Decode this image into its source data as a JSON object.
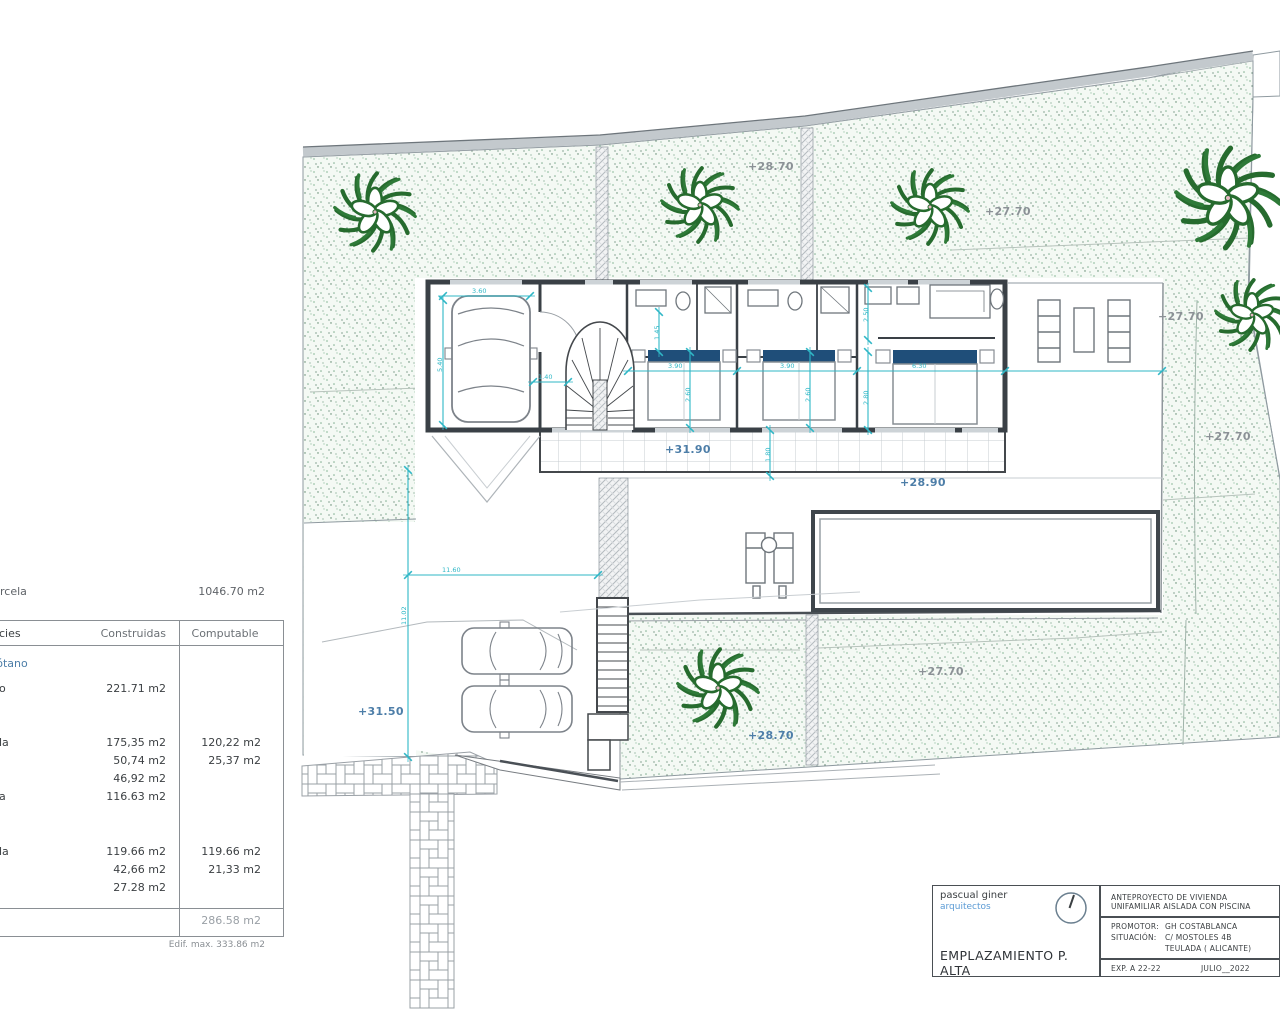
{
  "parcel_row": {
    "label_fragment": "rcela",
    "value": "1046.70 m2"
  },
  "areas_table": {
    "header": {
      "col0_fragment": "cies",
      "col1": "Construidas",
      "col2": "Computable"
    },
    "sections": [
      {
        "title": "Semisótano",
        "rows": [
          {
            "label": "o",
            "construidas": "221.71 m2",
            "computable": ""
          }
        ]
      },
      {
        "title": "Baja",
        "rows": [
          {
            "label": "la",
            "construidas": "175,35 m2",
            "computable": "120,22 m2"
          },
          {
            "label": "",
            "construidas": "50,74 m2",
            "computable": "25,37 m2"
          },
          {
            "label": "",
            "construidas": "46,92 m2",
            "computable": ""
          },
          {
            "label": "a",
            "construidas": "116.63 m2",
            "computable": ""
          }
        ]
      },
      {
        "title": "Alta",
        "rows": [
          {
            "label": "la",
            "construidas": "119.66 m2",
            "computable": "119.66 m2"
          },
          {
            "label": "",
            "construidas": "42,66 m2",
            "computable": "21,33 m2"
          },
          {
            "label": "",
            "construidas": "27.28 m2",
            "computable": ""
          }
        ]
      }
    ],
    "total_computable": "286.58 m2",
    "edif_max": "Edif. max. 333.86 m2"
  },
  "title_block": {
    "firm_name": "pascual giner",
    "firm_role": "arquitectos",
    "drawing_title": "EMPLAZAMIENTO P. ALTA",
    "project_line1": "ANTEPROYECTO  DE VIVIENDA",
    "project_line2": "UNIFAMILIAR AISLADA CON PISCINA",
    "promotor_label": "PROMOTOR:",
    "promotor": "GH COSTABLANCA",
    "situacion_label": "SITUACIÓN:",
    "situacion1": "C/ MOSTOLES 4B",
    "situacion2": "TEULADA  ( ALICANTE)",
    "exp": "EXP. A 22-22",
    "date": "JULIO__2022"
  },
  "plan": {
    "colors": {
      "dimension": "#2fb7c6",
      "elev_blue": "#4d7ea8",
      "elev_gray": "#8b9196",
      "tree": "#266b2e",
      "pillow": "#1f4e79"
    },
    "elevation_labels": [
      {
        "text": "+28.70",
        "x": 748,
        "y": 160,
        "tone": "gray"
      },
      {
        "text": "+27.70",
        "x": 985,
        "y": 205,
        "tone": "gray"
      },
      {
        "text": "+27.70",
        "x": 1158,
        "y": 310,
        "tone": "gray"
      },
      {
        "text": "+27.70",
        "x": 1205,
        "y": 430,
        "tone": "gray"
      },
      {
        "text": "+31.90",
        "x": 665,
        "y": 443,
        "tone": "blue"
      },
      {
        "text": "+28.90",
        "x": 900,
        "y": 476,
        "tone": "blue"
      },
      {
        "text": "+31.50",
        "x": 358,
        "y": 705,
        "tone": "blue"
      },
      {
        "text": "+28.70",
        "x": 748,
        "y": 729,
        "tone": "blue"
      },
      {
        "text": "+27.70",
        "x": 918,
        "y": 665,
        "tone": "gray"
      }
    ],
    "dimensions": [
      {
        "text": "3.60",
        "x": 472,
        "y": 287,
        "rot": false
      },
      {
        "text": "5.40",
        "x": 436,
        "y": 372,
        "rot": true
      },
      {
        "text": "1.40",
        "x": 538,
        "y": 373,
        "rot": false
      },
      {
        "text": "3.90",
        "x": 668,
        "y": 362,
        "rot": false
      },
      {
        "text": "3.90",
        "x": 780,
        "y": 362,
        "rot": false
      },
      {
        "text": "6.30",
        "x": 912,
        "y": 362,
        "rot": false
      },
      {
        "text": "1.45",
        "x": 653,
        "y": 340,
        "rot": true
      },
      {
        "text": "2.60",
        "x": 684,
        "y": 402,
        "rot": true
      },
      {
        "text": "2.60",
        "x": 804,
        "y": 402,
        "rot": true
      },
      {
        "text": "2.50",
        "x": 862,
        "y": 322,
        "rot": true
      },
      {
        "text": "2.80",
        "x": 862,
        "y": 405,
        "rot": true
      },
      {
        "text": "1.80",
        "x": 764,
        "y": 462,
        "rot": true
      },
      {
        "text": "11.60",
        "x": 442,
        "y": 566,
        "rot": false
      },
      {
        "text": "11.02",
        "x": 400,
        "y": 625,
        "rot": true
      }
    ]
  }
}
